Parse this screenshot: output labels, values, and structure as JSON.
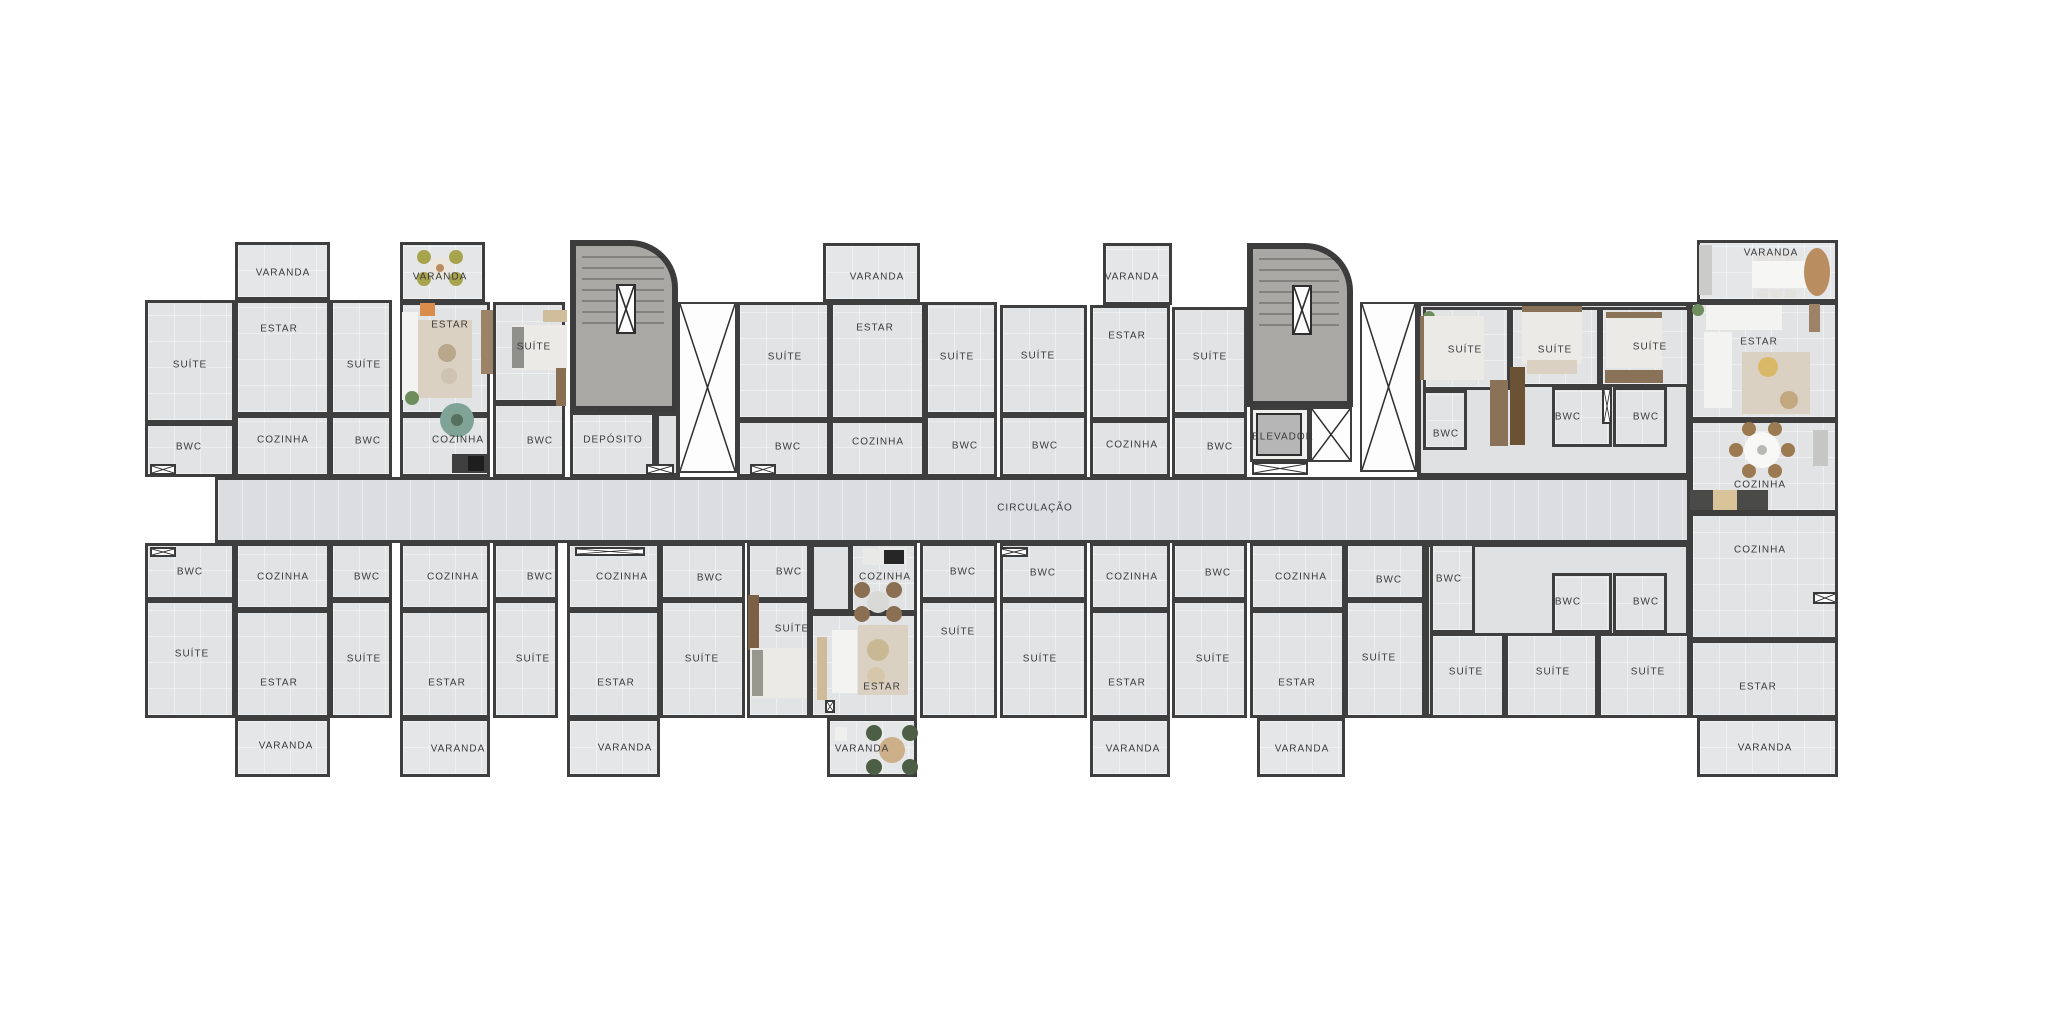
{
  "canvas": {
    "w": 2048,
    "h": 1024
  },
  "colors": {
    "wall": "#3e3e3e",
    "floor": "#e2e3e5",
    "corridor_floor": "#dcdde0",
    "stair_fill": "#a9a8a4",
    "background": "#ffffff",
    "text": "#3b3b3b",
    "wood": "#8a7258",
    "rug": "#dbd1c2",
    "plant": "#6d8d5c"
  },
  "corridor": {
    "label": "CIRCULAÇÃO",
    "x": 215,
    "y": 477,
    "w": 1475,
    "h": 66,
    "lx": 1035,
    "ly": 508
  },
  "halls": [
    {
      "x": 1417,
      "y": 302,
      "w": 273,
      "h": 175
    },
    {
      "x": 1425,
      "y": 543,
      "w": 265,
      "h": 175
    },
    {
      "x": 655,
      "y": 412,
      "w": 25,
      "h": 65
    },
    {
      "x": 810,
      "y": 543,
      "w": 42,
      "h": 70
    }
  ],
  "rooms": [
    {
      "label": "SUÍTE",
      "x": 145,
      "y": 300,
      "w": 90,
      "h": 123,
      "lx": 190,
      "ly": 365
    },
    {
      "label": "BWC",
      "x": 145,
      "y": 423,
      "w": 90,
      "h": 54,
      "lx": 189,
      "ly": 447
    },
    {
      "label": "VARANDA",
      "x": 235,
      "y": 242,
      "w": 95,
      "h": 58,
      "lx": 283,
      "ly": 273,
      "k": "v"
    },
    {
      "label": "ESTAR",
      "x": 235,
      "y": 300,
      "w": 95,
      "h": 115,
      "lx": 279,
      "ly": 329
    },
    {
      "label": "COZINHA",
      "x": 235,
      "y": 415,
      "w": 95,
      "h": 62,
      "lx": 283,
      "ly": 440
    },
    {
      "label": "SUÍTE",
      "x": 330,
      "y": 300,
      "w": 62,
      "h": 115,
      "lx": 364,
      "ly": 365
    },
    {
      "label": "BWC",
      "x": 330,
      "y": 415,
      "w": 62,
      "h": 62,
      "lx": 368,
      "ly": 441
    },
    {
      "label": "VARANDA",
      "x": 400,
      "y": 242,
      "w": 85,
      "h": 60,
      "lx": 440,
      "ly": 277,
      "k": "v"
    },
    {
      "label": "ESTAR",
      "x": 400,
      "y": 302,
      "w": 90,
      "h": 113,
      "lx": 450,
      "ly": 325
    },
    {
      "label": "COZINHA",
      "x": 400,
      "y": 415,
      "w": 90,
      "h": 62,
      "lx": 458,
      "ly": 440
    },
    {
      "label": "SUÍTE",
      "x": 493,
      "y": 302,
      "w": 72,
      "h": 101,
      "lx": 534,
      "ly": 347
    },
    {
      "label": "BWC",
      "x": 493,
      "y": 403,
      "w": 72,
      "h": 74,
      "lx": 540,
      "ly": 441
    },
    {
      "label": "DEPÓSITO",
      "x": 570,
      "y": 412,
      "w": 85,
      "h": 65,
      "lx": 613,
      "ly": 440
    },
    {
      "label": "SUÍTE",
      "x": 737,
      "y": 302,
      "w": 93,
      "h": 118,
      "lx": 785,
      "ly": 357
    },
    {
      "label": "BWC",
      "x": 737,
      "y": 420,
      "w": 93,
      "h": 57,
      "lx": 788,
      "ly": 447
    },
    {
      "label": "VARANDA",
      "x": 823,
      "y": 243,
      "w": 97,
      "h": 59,
      "lx": 877,
      "ly": 277,
      "k": "v"
    },
    {
      "label": "ESTAR",
      "x": 830,
      "y": 302,
      "w": 95,
      "h": 118,
      "lx": 875,
      "ly": 328
    },
    {
      "label": "COZINHA",
      "x": 830,
      "y": 420,
      "w": 95,
      "h": 57,
      "lx": 878,
      "ly": 442
    },
    {
      "label": "SUÍTE",
      "x": 925,
      "y": 302,
      "w": 72,
      "h": 113,
      "lx": 957,
      "ly": 357
    },
    {
      "label": "BWC",
      "x": 925,
      "y": 415,
      "w": 72,
      "h": 62,
      "lx": 965,
      "ly": 446
    },
    {
      "label": "SUÍTE",
      "x": 1000,
      "y": 305,
      "w": 87,
      "h": 110,
      "lx": 1038,
      "ly": 356
    },
    {
      "label": "BWC",
      "x": 1000,
      "y": 415,
      "w": 87,
      "h": 62,
      "lx": 1045,
      "ly": 446
    },
    {
      "label": "VARANDA",
      "x": 1103,
      "y": 243,
      "w": 69,
      "h": 62,
      "lx": 1132,
      "ly": 277,
      "k": "v"
    },
    {
      "label": "ESTAR",
      "x": 1090,
      "y": 305,
      "w": 80,
      "h": 115,
      "lx": 1127,
      "ly": 336
    },
    {
      "label": "COZINHA",
      "x": 1090,
      "y": 420,
      "w": 80,
      "h": 57,
      "lx": 1132,
      "ly": 445
    },
    {
      "label": "SUÍTE",
      "x": 1172,
      "y": 307,
      "w": 75,
      "h": 108,
      "lx": 1210,
      "ly": 357
    },
    {
      "label": "BWC",
      "x": 1172,
      "y": 415,
      "w": 75,
      "h": 62,
      "lx": 1220,
      "ly": 447
    },
    {
      "label": "ELEVADOR",
      "x": 1250,
      "y": 407,
      "w": 60,
      "h": 55,
      "lx": 1283,
      "ly": 437,
      "k": "e"
    },
    {
      "label": "SUÍTE",
      "x": 1423,
      "y": 307,
      "w": 87,
      "h": 83,
      "lx": 1465,
      "ly": 350
    },
    {
      "label": "BWC",
      "x": 1423,
      "y": 390,
      "w": 44,
      "h": 60,
      "lx": 1446,
      "ly": 434
    },
    {
      "label": "SUÍTE",
      "x": 1510,
      "y": 307,
      "w": 90,
      "h": 80,
      "lx": 1555,
      "ly": 350
    },
    {
      "label": "SUÍTE",
      "x": 1600,
      "y": 307,
      "w": 90,
      "h": 80,
      "lx": 1650,
      "ly": 347
    },
    {
      "label": "BWC",
      "x": 1552,
      "y": 387,
      "w": 60,
      "h": 60,
      "lx": 1568,
      "ly": 417
    },
    {
      "label": "BWC",
      "x": 1613,
      "y": 387,
      "w": 54,
      "h": 60,
      "lx": 1646,
      "ly": 417
    },
    {
      "label": "VARANDA",
      "x": 1697,
      "y": 240,
      "w": 141,
      "h": 62,
      "lx": 1771,
      "ly": 253,
      "k": "v"
    },
    {
      "label": "ESTAR",
      "x": 1690,
      "y": 302,
      "w": 148,
      "h": 118,
      "lx": 1759,
      "ly": 342
    },
    {
      "label": "COZINHA",
      "x": 1690,
      "y": 420,
      "w": 148,
      "h": 93,
      "lx": 1760,
      "ly": 485
    },
    {
      "label": "BWC",
      "x": 145,
      "y": 543,
      "w": 90,
      "h": 57,
      "lx": 190,
      "ly": 572
    },
    {
      "label": "SUÍTE",
      "x": 145,
      "y": 600,
      "w": 90,
      "h": 118,
      "lx": 192,
      "ly": 654
    },
    {
      "label": "COZINHA",
      "x": 235,
      "y": 543,
      "w": 95,
      "h": 67,
      "lx": 283,
      "ly": 577
    },
    {
      "label": "ESTAR",
      "x": 235,
      "y": 610,
      "w": 95,
      "h": 108,
      "lx": 279,
      "ly": 683
    },
    {
      "label": "VARANDA",
      "x": 235,
      "y": 718,
      "w": 95,
      "h": 59,
      "lx": 286,
      "ly": 746,
      "k": "v"
    },
    {
      "label": "BWC",
      "x": 330,
      "y": 543,
      "w": 62,
      "h": 57,
      "lx": 367,
      "ly": 577
    },
    {
      "label": "SUÍTE",
      "x": 330,
      "y": 600,
      "w": 62,
      "h": 118,
      "lx": 364,
      "ly": 659
    },
    {
      "label": "COZINHA",
      "x": 400,
      "y": 543,
      "w": 90,
      "h": 67,
      "lx": 453,
      "ly": 577
    },
    {
      "label": "ESTAR",
      "x": 400,
      "y": 610,
      "w": 90,
      "h": 108,
      "lx": 447,
      "ly": 683
    },
    {
      "label": "VARANDA",
      "x": 400,
      "y": 718,
      "w": 90,
      "h": 59,
      "lx": 458,
      "ly": 749,
      "k": "v"
    },
    {
      "label": "BWC",
      "x": 493,
      "y": 543,
      "w": 65,
      "h": 57,
      "lx": 540,
      "ly": 577
    },
    {
      "label": "SUÍTE",
      "x": 493,
      "y": 600,
      "w": 65,
      "h": 118,
      "lx": 533,
      "ly": 659
    },
    {
      "label": "COZINHA",
      "x": 567,
      "y": 543,
      "w": 93,
      "h": 67,
      "lx": 622,
      "ly": 577
    },
    {
      "label": "ESTAR",
      "x": 567,
      "y": 610,
      "w": 93,
      "h": 108,
      "lx": 616,
      "ly": 683
    },
    {
      "label": "VARANDA",
      "x": 567,
      "y": 718,
      "w": 93,
      "h": 59,
      "lx": 625,
      "ly": 748,
      "k": "v"
    },
    {
      "label": "BWC",
      "x": 660,
      "y": 543,
      "w": 85,
      "h": 57,
      "lx": 710,
      "ly": 578
    },
    {
      "label": "SUÍTE",
      "x": 660,
      "y": 600,
      "w": 85,
      "h": 118,
      "lx": 702,
      "ly": 659
    },
    {
      "label": "BWC",
      "x": 747,
      "y": 543,
      "w": 63,
      "h": 57,
      "lx": 789,
      "ly": 572
    },
    {
      "label": "SUÍTE",
      "x": 747,
      "y": 600,
      "w": 63,
      "h": 118,
      "lx": 792,
      "ly": 629
    },
    {
      "label": "COZINHA",
      "x": 850,
      "y": 543,
      "w": 67,
      "h": 70,
      "lx": 885,
      "ly": 577
    },
    {
      "label": "ESTAR",
      "x": 810,
      "y": 613,
      "w": 107,
      "h": 105,
      "lx": 882,
      "ly": 687
    },
    {
      "label": "VARANDA",
      "x": 827,
      "y": 718,
      "w": 90,
      "h": 59,
      "lx": 862,
      "ly": 749,
      "k": "v"
    },
    {
      "label": "BWC",
      "x": 920,
      "y": 543,
      "w": 77,
      "h": 57,
      "lx": 963,
      "ly": 572
    },
    {
      "label": "SUÍTE",
      "x": 920,
      "y": 600,
      "w": 77,
      "h": 118,
      "lx": 958,
      "ly": 632
    },
    {
      "label": "BWC",
      "x": 1000,
      "y": 543,
      "w": 87,
      "h": 57,
      "lx": 1043,
      "ly": 573
    },
    {
      "label": "SUÍTE",
      "x": 1000,
      "y": 600,
      "w": 87,
      "h": 118,
      "lx": 1040,
      "ly": 659
    },
    {
      "label": "COZINHA",
      "x": 1090,
      "y": 543,
      "w": 80,
      "h": 67,
      "lx": 1132,
      "ly": 577
    },
    {
      "label": "ESTAR",
      "x": 1090,
      "y": 610,
      "w": 80,
      "h": 108,
      "lx": 1127,
      "ly": 683
    },
    {
      "label": "VARANDA",
      "x": 1090,
      "y": 718,
      "w": 80,
      "h": 59,
      "lx": 1133,
      "ly": 749,
      "k": "v"
    },
    {
      "label": "BWC",
      "x": 1172,
      "y": 543,
      "w": 75,
      "h": 57,
      "lx": 1218,
      "ly": 573
    },
    {
      "label": "SUÍTE",
      "x": 1172,
      "y": 600,
      "w": 75,
      "h": 118,
      "lx": 1213,
      "ly": 659
    },
    {
      "label": "COZINHA",
      "x": 1250,
      "y": 543,
      "w": 95,
      "h": 67,
      "lx": 1301,
      "ly": 577
    },
    {
      "label": "ESTAR",
      "x": 1250,
      "y": 610,
      "w": 95,
      "h": 108,
      "lx": 1297,
      "ly": 683
    },
    {
      "label": "VARANDA",
      "x": 1257,
      "y": 718,
      "w": 88,
      "h": 59,
      "lx": 1302,
      "ly": 749,
      "k": "v"
    },
    {
      "label": "BWC",
      "x": 1345,
      "y": 543,
      "w": 80,
      "h": 57,
      "lx": 1389,
      "ly": 580
    },
    {
      "label": "SUÍTE",
      "x": 1345,
      "y": 600,
      "w": 80,
      "h": 118,
      "lx": 1379,
      "ly": 658
    },
    {
      "label": "BWC",
      "x": 1430,
      "y": 543,
      "w": 45,
      "h": 90,
      "lx": 1449,
      "ly": 579
    },
    {
      "label": "BWC",
      "x": 1552,
      "y": 573,
      "w": 60,
      "h": 60,
      "lx": 1568,
      "ly": 602
    },
    {
      "label": "BWC",
      "x": 1613,
      "y": 573,
      "w": 54,
      "h": 60,
      "lx": 1646,
      "ly": 602
    },
    {
      "label": "SUÍTE",
      "x": 1430,
      "y": 633,
      "w": 75,
      "h": 85,
      "lx": 1466,
      "ly": 672
    },
    {
      "label": "SUÍTE",
      "x": 1505,
      "y": 633,
      "w": 93,
      "h": 85,
      "lx": 1553,
      "ly": 672
    },
    {
      "label": "SUÍTE",
      "x": 1598,
      "y": 633,
      "w": 92,
      "h": 85,
      "lx": 1648,
      "ly": 672
    },
    {
      "label": "COZINHA",
      "x": 1690,
      "y": 513,
      "w": 148,
      "h": 127,
      "lx": 1760,
      "ly": 550
    },
    {
      "label": "ESTAR",
      "x": 1690,
      "y": 640,
      "w": 148,
      "h": 78,
      "lx": 1758,
      "ly": 687
    },
    {
      "label": "VARANDA",
      "x": 1697,
      "y": 718,
      "w": 141,
      "h": 59,
      "lx": 1765,
      "ly": 748,
      "k": "v"
    }
  ],
  "stairs": [
    {
      "x": 570,
      "y": 240,
      "w": 108,
      "h": 172
    },
    {
      "x": 1247,
      "y": 243,
      "w": 106,
      "h": 164
    }
  ],
  "voids": [
    {
      "x": 678,
      "y": 302,
      "w": 59,
      "h": 171
    },
    {
      "x": 1360,
      "y": 302,
      "w": 57,
      "h": 170
    },
    {
      "x": 1310,
      "y": 407,
      "w": 42,
      "h": 55
    }
  ],
  "ducts": [
    {
      "x": 150,
      "y": 464,
      "w": 26,
      "h": 11
    },
    {
      "x": 646,
      "y": 464,
      "w": 28,
      "h": 11
    },
    {
      "x": 750,
      "y": 464,
      "w": 26,
      "h": 11
    },
    {
      "x": 1252,
      "y": 462,
      "w": 56,
      "h": 13
    },
    {
      "x": 150,
      "y": 547,
      "w": 26,
      "h": 10
    },
    {
      "x": 575,
      "y": 547,
      "w": 70,
      "h": 9
    },
    {
      "x": 1000,
      "y": 547,
      "w": 28,
      "h": 10
    },
    {
      "x": 1602,
      "y": 388,
      "w": 10,
      "h": 36
    },
    {
      "x": 1813,
      "y": 592,
      "w": 24,
      "h": 12
    },
    {
      "x": 825,
      "y": 700,
      "w": 10,
      "h": 13
    }
  ],
  "furniture": [
    [
      "r",
      415,
      320,
      57,
      78,
      "#dbd1c2"
    ],
    [
      "r",
      402,
      312,
      16,
      88,
      "#f3f3f1"
    ],
    [
      "r",
      420,
      303,
      15,
      13,
      "#d98c4b"
    ],
    [
      "c",
      447,
      353,
      9,
      9,
      "#b9a78c"
    ],
    [
      "c",
      449,
      376,
      8,
      8,
      "#cec2b0"
    ],
    [
      "r",
      481,
      310,
      12,
      64,
      "#9c8266"
    ],
    [
      "c",
      412,
      398,
      7,
      7,
      "#6d8d5c"
    ],
    [
      "c",
      457,
      420,
      17,
      17,
      "#7fa396"
    ],
    [
      "c",
      457,
      420,
      6,
      6,
      "#55705f"
    ],
    [
      "r",
      512,
      325,
      55,
      45,
      "#eceae7"
    ],
    [
      "r",
      512,
      327,
      12,
      41,
      "#8f8f8c"
    ],
    [
      "r",
      556,
      368,
      10,
      38,
      "#8a6f52"
    ],
    [
      "r",
      543,
      310,
      24,
      12,
      "#cfbd9b"
    ],
    [
      "r",
      452,
      454,
      38,
      19,
      "#3f3f3f"
    ],
    [
      "r",
      468,
      456,
      16,
      15,
      "#1e1e1e"
    ],
    [
      "c",
      440,
      268,
      11,
      11,
      "#eae6dc"
    ],
    [
      "c",
      424,
      257,
      7,
      7,
      "#a8a44e"
    ],
    [
      "c",
      456,
      257,
      7,
      7,
      "#a8a44e"
    ],
    [
      "c",
      424,
      279,
      7,
      7,
      "#a8a44e"
    ],
    [
      "c",
      456,
      279,
      7,
      7,
      "#a8a44e"
    ],
    [
      "c",
      440,
      268,
      4,
      4,
      "#b98d5f"
    ],
    [
      "r",
      748,
      595,
      11,
      55,
      "#7c6046"
    ],
    [
      "r",
      750,
      648,
      57,
      50,
      "#eceae7"
    ],
    [
      "r",
      752,
      650,
      11,
      46,
      "#97978f"
    ],
    [
      "r",
      817,
      637,
      10,
      63,
      "#cdbb9a"
    ],
    [
      "r",
      858,
      625,
      50,
      70,
      "#dbd1c2"
    ],
    [
      "r",
      832,
      630,
      25,
      63,
      "#f3f3f1"
    ],
    [
      "c",
      878,
      650,
      11,
      11,
      "#c9b894"
    ],
    [
      "c",
      876,
      676,
      9,
      9,
      "#d6c7ab"
    ],
    [
      "c",
      862,
      590,
      8,
      8,
      "#8a6f52"
    ],
    [
      "c",
      894,
      590,
      8,
      8,
      "#8a6f52"
    ],
    [
      "c",
      862,
      614,
      8,
      8,
      "#8a6f52"
    ],
    [
      "c",
      894,
      614,
      8,
      8,
      "#8a6f52"
    ],
    [
      "c",
      878,
      602,
      11,
      11,
      "#d9d9d5"
    ],
    [
      "r",
      863,
      548,
      44,
      17,
      "#e9e9e7"
    ],
    [
      "r",
      884,
      550,
      20,
      14,
      "#262626"
    ],
    [
      "c",
      874,
      733,
      8,
      8,
      "#4c5f44"
    ],
    [
      "c",
      910,
      733,
      8,
      8,
      "#4c5f44"
    ],
    [
      "c",
      874,
      767,
      8,
      8,
      "#4c5f44"
    ],
    [
      "c",
      910,
      767,
      8,
      8,
      "#4c5f44"
    ],
    [
      "c",
      892,
      750,
      13,
      13,
      "#cdb089"
    ],
    [
      "r",
      835,
      727,
      12,
      14,
      "#efefed"
    ],
    [
      "r",
      1757,
      252,
      11,
      9,
      "#e3e2de"
    ],
    [
      "r",
      1771,
      252,
      11,
      9,
      "#e3e2de"
    ],
    [
      "r",
      1785,
      252,
      11,
      9,
      "#e3e2de"
    ],
    [
      "r",
      1752,
      261,
      55,
      27,
      "#f6f6f4"
    ],
    [
      "r",
      1757,
      289,
      11,
      9,
      "#e3e2de"
    ],
    [
      "r",
      1771,
      289,
      11,
      9,
      "#e3e2de"
    ],
    [
      "r",
      1785,
      289,
      11,
      9,
      "#e3e2de"
    ],
    [
      "e",
      1817,
      272,
      13,
      24,
      "#b98d5f"
    ],
    [
      "r",
      1699,
      245,
      13,
      50,
      "#cbcbc9"
    ],
    [
      "r",
      1742,
      352,
      68,
      62,
      "#dbd1c2"
    ],
    [
      "r",
      1706,
      305,
      76,
      25,
      "#f3f3f1"
    ],
    [
      "r",
      1704,
      332,
      28,
      76,
      "#f3f3f1"
    ],
    [
      "c",
      1768,
      367,
      10,
      10,
      "#d9b967"
    ],
    [
      "c",
      1789,
      400,
      9,
      9,
      "#c2a87e"
    ],
    [
      "r",
      1809,
      304,
      11,
      28,
      "#9c8266"
    ],
    [
      "c",
      1698,
      310,
      6,
      6,
      "#6d8d5c"
    ],
    [
      "c",
      1788,
      450,
      7,
      7,
      "#9b7a52"
    ],
    [
      "c",
      1775,
      471,
      7,
      7,
      "#9b7a52"
    ],
    [
      "c",
      1749,
      471,
      7,
      7,
      "#9b7a52"
    ],
    [
      "c",
      1736,
      450,
      7,
      7,
      "#9b7a52"
    ],
    [
      "c",
      1749,
      429,
      7,
      7,
      "#9b7a52"
    ],
    [
      "c",
      1775,
      429,
      7,
      7,
      "#9b7a52"
    ],
    [
      "c",
      1762,
      450,
      18,
      18,
      "#f8f8f6"
    ],
    [
      "c",
      1762,
      450,
      5,
      5,
      "#b9b9b4"
    ],
    [
      "r",
      1690,
      490,
      78,
      20,
      "#4a4a48"
    ],
    [
      "r",
      1713,
      490,
      24,
      20,
      "#d9c49a"
    ],
    [
      "r",
      1813,
      430,
      15,
      36,
      "#c6c6c4"
    ],
    [
      "c",
      1429,
      317,
      6,
      6,
      "#6d8d5c"
    ],
    [
      "r",
      1420,
      316,
      6,
      64,
      "#8a7258"
    ],
    [
      "r",
      1424,
      316,
      60,
      64,
      "#eceae7"
    ],
    [
      "r",
      1490,
      380,
      18,
      66,
      "#8a7258"
    ],
    [
      "r",
      1510,
      367,
      15,
      78,
      "#6b5234"
    ],
    [
      "r",
      1522,
      306,
      60,
      6,
      "#8a7258"
    ],
    [
      "r",
      1522,
      312,
      60,
      52,
      "#eceae7"
    ],
    [
      "r",
      1527,
      360,
      50,
      14,
      "#dbd1c2"
    ],
    [
      "r",
      1606,
      312,
      56,
      6,
      "#8a7258"
    ],
    [
      "r",
      1606,
      318,
      56,
      50,
      "#eceae7"
    ],
    [
      "r",
      1605,
      370,
      58,
      13,
      "#8a7258"
    ]
  ]
}
